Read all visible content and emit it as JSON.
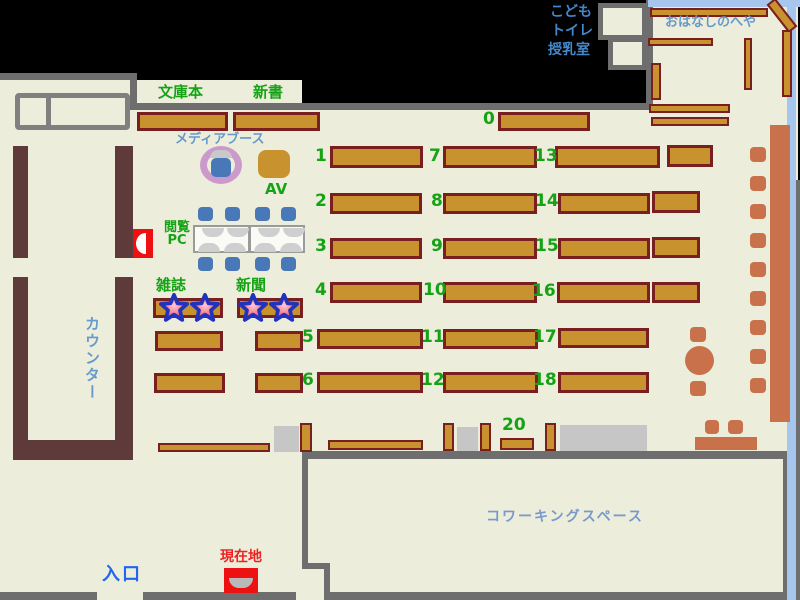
{
  "map_type": "library-floor-map",
  "colors": {
    "background": "#000000",
    "floor": "#ecedda",
    "wall_gray": "#6e6e6e",
    "shelf_fill": "#c8922e",
    "shelf_border": "#7a1f1f",
    "counter_brown": "#5e3a3a",
    "chair_sienna": "#c9714a",
    "chair_blue": "#4878b8",
    "media_ring_plum": "#cc99cc",
    "glass_wall_blue": "#a6c6ee",
    "label_green": "#15a315",
    "label_blue": "#6699cc",
    "label_kids_blue": "#4488cc",
    "label_cowork_blue": "#7799cc",
    "label_entrance_blue": "#2266ee",
    "label_red": "#ee2222",
    "marker_red": "#ee1111"
  },
  "labels": [
    {
      "name": "paperbacks",
      "text": "文庫本",
      "x": 158,
      "y": 84,
      "cls": "g15"
    },
    {
      "name": "new-books",
      "text": "新書",
      "x": 253,
      "y": 84,
      "cls": "g15"
    },
    {
      "name": "shelf-number-0",
      "text": "0",
      "x": 483,
      "y": 110,
      "cls": "num"
    },
    {
      "name": "shelf-number-1",
      "text": "1",
      "x": 315,
      "y": 147,
      "cls": "num"
    },
    {
      "name": "shelf-number-7",
      "text": "7",
      "x": 429,
      "y": 147,
      "cls": "num"
    },
    {
      "name": "shelf-number-13",
      "text": "13",
      "x": 534,
      "y": 147,
      "cls": "num"
    },
    {
      "name": "shelf-number-2",
      "text": "2",
      "x": 315,
      "y": 192,
      "cls": "num"
    },
    {
      "name": "shelf-number-8",
      "text": "8",
      "x": 431,
      "y": 192,
      "cls": "num"
    },
    {
      "name": "shelf-number-14",
      "text": "14",
      "x": 535,
      "y": 192,
      "cls": "num"
    },
    {
      "name": "shelf-number-3",
      "text": "3",
      "x": 315,
      "y": 237,
      "cls": "num"
    },
    {
      "name": "shelf-number-9",
      "text": "9",
      "x": 431,
      "y": 237,
      "cls": "num"
    },
    {
      "name": "shelf-number-15",
      "text": "15",
      "x": 535,
      "y": 237,
      "cls": "num"
    },
    {
      "name": "shelf-number-4",
      "text": "4",
      "x": 315,
      "y": 281,
      "cls": "num"
    },
    {
      "name": "shelf-number-10",
      "text": "10",
      "x": 423,
      "y": 281,
      "cls": "num"
    },
    {
      "name": "shelf-number-16",
      "text": "16",
      "x": 532,
      "y": 282,
      "cls": "num"
    },
    {
      "name": "shelf-number-5",
      "text": "5",
      "x": 302,
      "y": 328,
      "cls": "num"
    },
    {
      "name": "shelf-number-11",
      "text": "11",
      "x": 421,
      "y": 328,
      "cls": "num"
    },
    {
      "name": "shelf-number-17",
      "text": "17",
      "x": 533,
      "y": 328,
      "cls": "num"
    },
    {
      "name": "shelf-number-6",
      "text": "6",
      "x": 302,
      "y": 371,
      "cls": "num"
    },
    {
      "name": "shelf-number-12",
      "text": "12",
      "x": 421,
      "y": 371,
      "cls": "num"
    },
    {
      "name": "shelf-number-18",
      "text": "18",
      "x": 533,
      "y": 371,
      "cls": "num"
    },
    {
      "name": "shelf-number-20",
      "text": "20",
      "x": 502,
      "y": 416,
      "cls": "num"
    },
    {
      "name": "media-booth",
      "text": "メディアブース",
      "x": 175,
      "y": 133,
      "cls": "b13"
    },
    {
      "name": "av",
      "text": "AV",
      "x": 265,
      "y": 181,
      "cls": "g15"
    },
    {
      "name": "reading-pc",
      "text": "閲覧\nPC",
      "x": 160,
      "y": 221,
      "cls": "g13c"
    },
    {
      "name": "magazines",
      "text": "雑誌",
      "x": 156,
      "y": 277,
      "cls": "g15"
    },
    {
      "name": "newspapers",
      "text": "新聞",
      "x": 236,
      "y": 277,
      "cls": "g15"
    },
    {
      "name": "counter",
      "text": "カウンター",
      "x": 84,
      "y": 316,
      "cls": "bv"
    },
    {
      "name": "kids",
      "text": "こども",
      "x": 550,
      "y": 5,
      "cls": "bb14"
    },
    {
      "name": "toilet",
      "text": "トイレ",
      "x": 551,
      "y": 24,
      "cls": "bb14"
    },
    {
      "name": "nursing-room",
      "text": "授乳室",
      "x": 548,
      "y": 43,
      "cls": "bb14"
    },
    {
      "name": "story-room",
      "text": "おはなしのへや",
      "x": 665,
      "y": 16,
      "cls": "b13"
    },
    {
      "name": "coworking-space",
      "text": "コワーキングスペース",
      "x": 486,
      "y": 510,
      "cls": "cw14"
    },
    {
      "name": "entrance",
      "text": "入口",
      "x": 102,
      "y": 565,
      "cls": "ent"
    },
    {
      "name": "current-location",
      "text": "現在地",
      "x": 220,
      "y": 550,
      "cls": "red14"
    }
  ]
}
